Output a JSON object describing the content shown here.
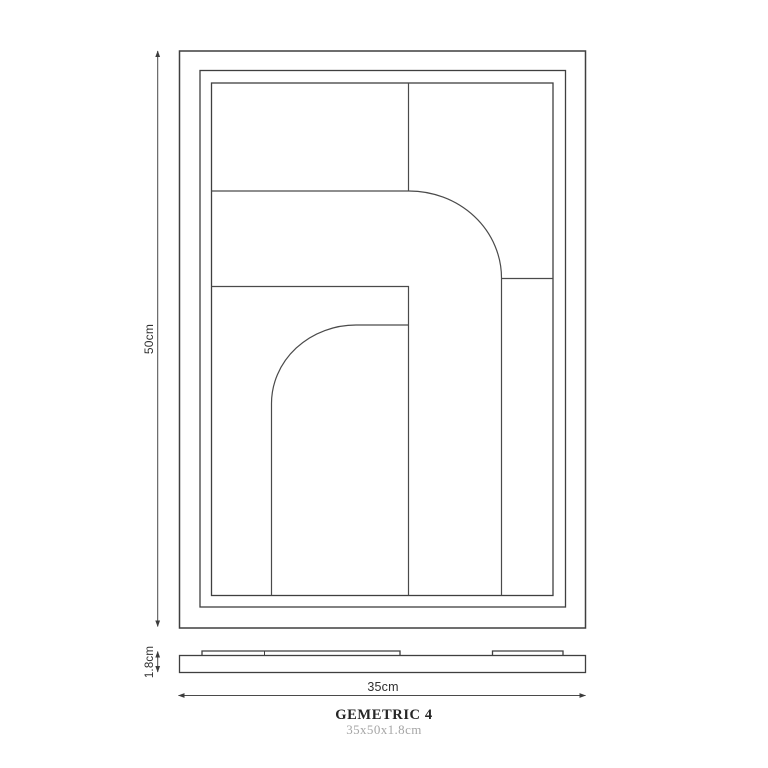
{
  "drawing": {
    "title": "GEMETRIC 4",
    "subtitle": "35x50x1.8cm",
    "dimensions": {
      "height_label": "50cm",
      "width_label": "35cm",
      "depth_label": "1.8cm"
    },
    "views": {
      "front": "framed geometric artwork front view",
      "side": "profile view with hanging battens"
    },
    "colors": {
      "background": "#ffffff",
      "frame_line": "#3f3f3f",
      "panel_line": "#4a4a4a",
      "dimension_line": "#4a4a4a",
      "dimension_text": "#303030",
      "title_text": "#262626",
      "subtitle_text": "#a6a6a6"
    }
  }
}
